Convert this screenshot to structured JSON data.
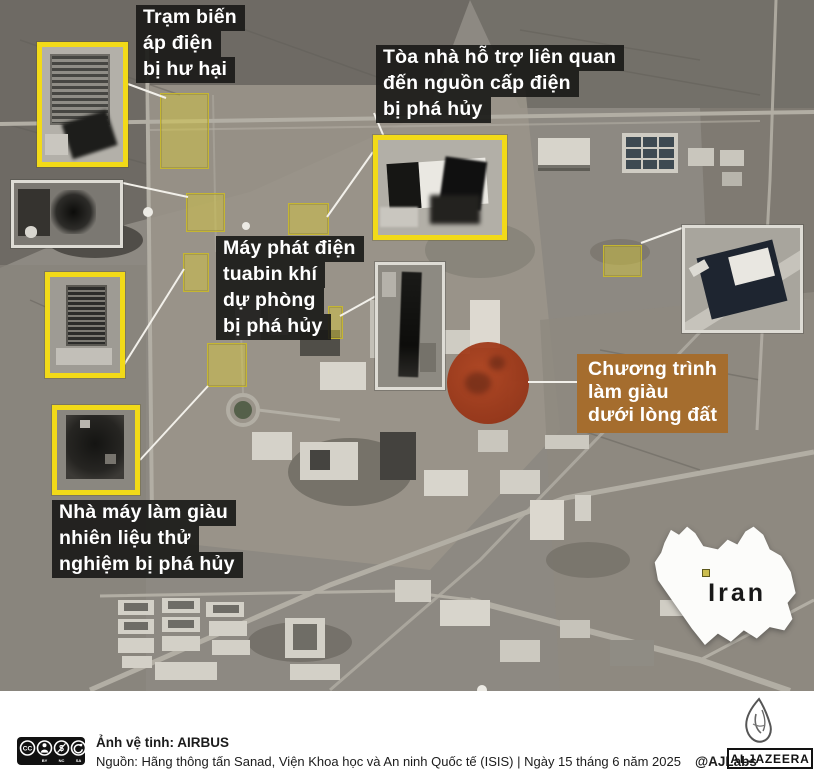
{
  "callouts": {
    "substation": {
      "lines": [
        "Trạm biến",
        "áp điện",
        "bị hư hại"
      ]
    },
    "support_building": {
      "lines": [
        "Tòa nhà hỗ trợ liên quan",
        "đến nguồn cấp điện",
        "bị phá hủy"
      ]
    },
    "turbine_generator": {
      "lines": [
        "Máy phát điện",
        "tuabin khí",
        "dự phòng",
        "bị phá hủy"
      ]
    },
    "underground_program": {
      "lines": [
        "Chương trình",
        "làm giàu",
        "dưới lòng đất"
      ]
    },
    "fuel_enrichment_plant": {
      "lines": [
        "Nhà máy làm giàu",
        "nhiên liệu thử",
        "nghiệm bị phá hủy"
      ]
    }
  },
  "map_inset": {
    "country_label": "Iran"
  },
  "footer": {
    "satellite_credit": "Ảnh vệ tinh: AIRBUS",
    "source_line": "Nguồn: Hãng thông tấn Sanad, Viện Khoa học và An ninh Quốc tế (ISIS) | Ngày 15 tháng 6 năm 2025",
    "handle": "@AJLabs",
    "brand_wordmark": "ALJAZEERA",
    "license_labels": {
      "cc": "CC",
      "by": "BY",
      "nc": "NC",
      "sa": "SA"
    }
  },
  "colors": {
    "callout_dark_bg": "#1a1a18",
    "callout_orange_bg": "#a56d2e",
    "highlight_yellow_border": "#f2da18",
    "impact_red": "#9c3819",
    "terrain_base": "#8d8982"
  }
}
